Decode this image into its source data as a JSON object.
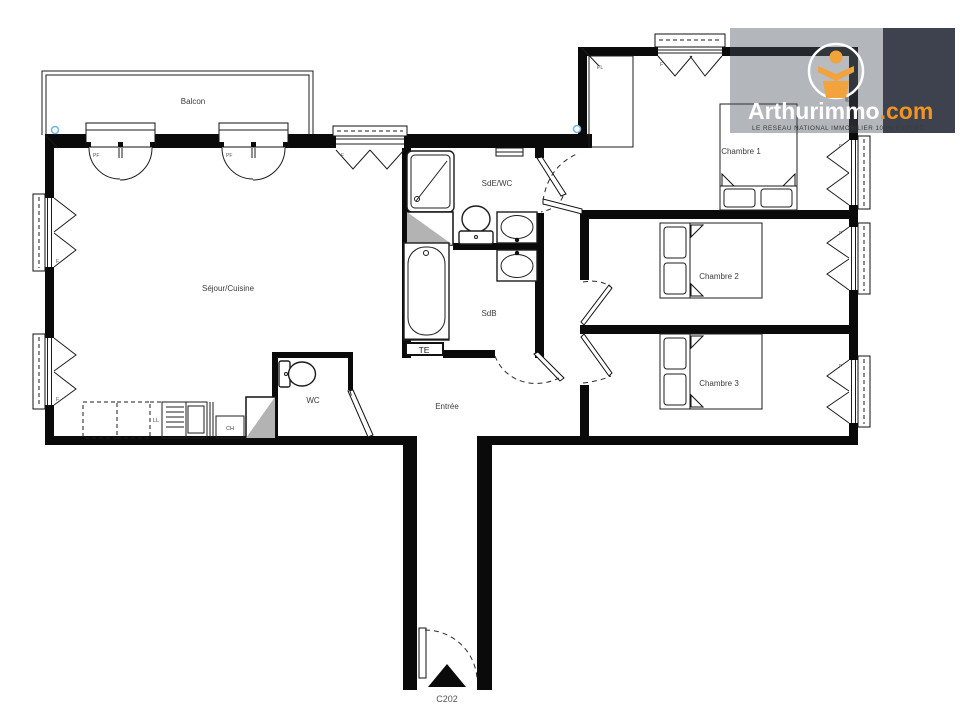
{
  "floorplan": {
    "unit_label": "C202",
    "rooms": {
      "balcon": "Balcon",
      "sejour": "Séjour/Cuisine",
      "sde_wc": "SdE/WC",
      "sdb": "SdB",
      "wc": "WC",
      "entree": "Entrée",
      "chambre1": "Chambre 1",
      "chambre2": "Chambre 2",
      "chambre3": "Chambre 3"
    },
    "tags": {
      "pf": "PF",
      "f": "F",
      "pl": "PL",
      "te": "TE",
      "ll": "LL",
      "ch": "CH"
    },
    "colors": {
      "wall": "#0a0a0a",
      "shaft_gray": "#b3b3b3",
      "symbol_blue": "#7ab3d9"
    }
  },
  "logo": {
    "brand": "Arthurimmo",
    "tld": ".com",
    "registered": "®",
    "tagline": "LE RESEAU NATIONAL IMMOBILIER 100% EXPERT",
    "colors": {
      "orange": "#f29422",
      "panel": "#3d424e"
    }
  }
}
